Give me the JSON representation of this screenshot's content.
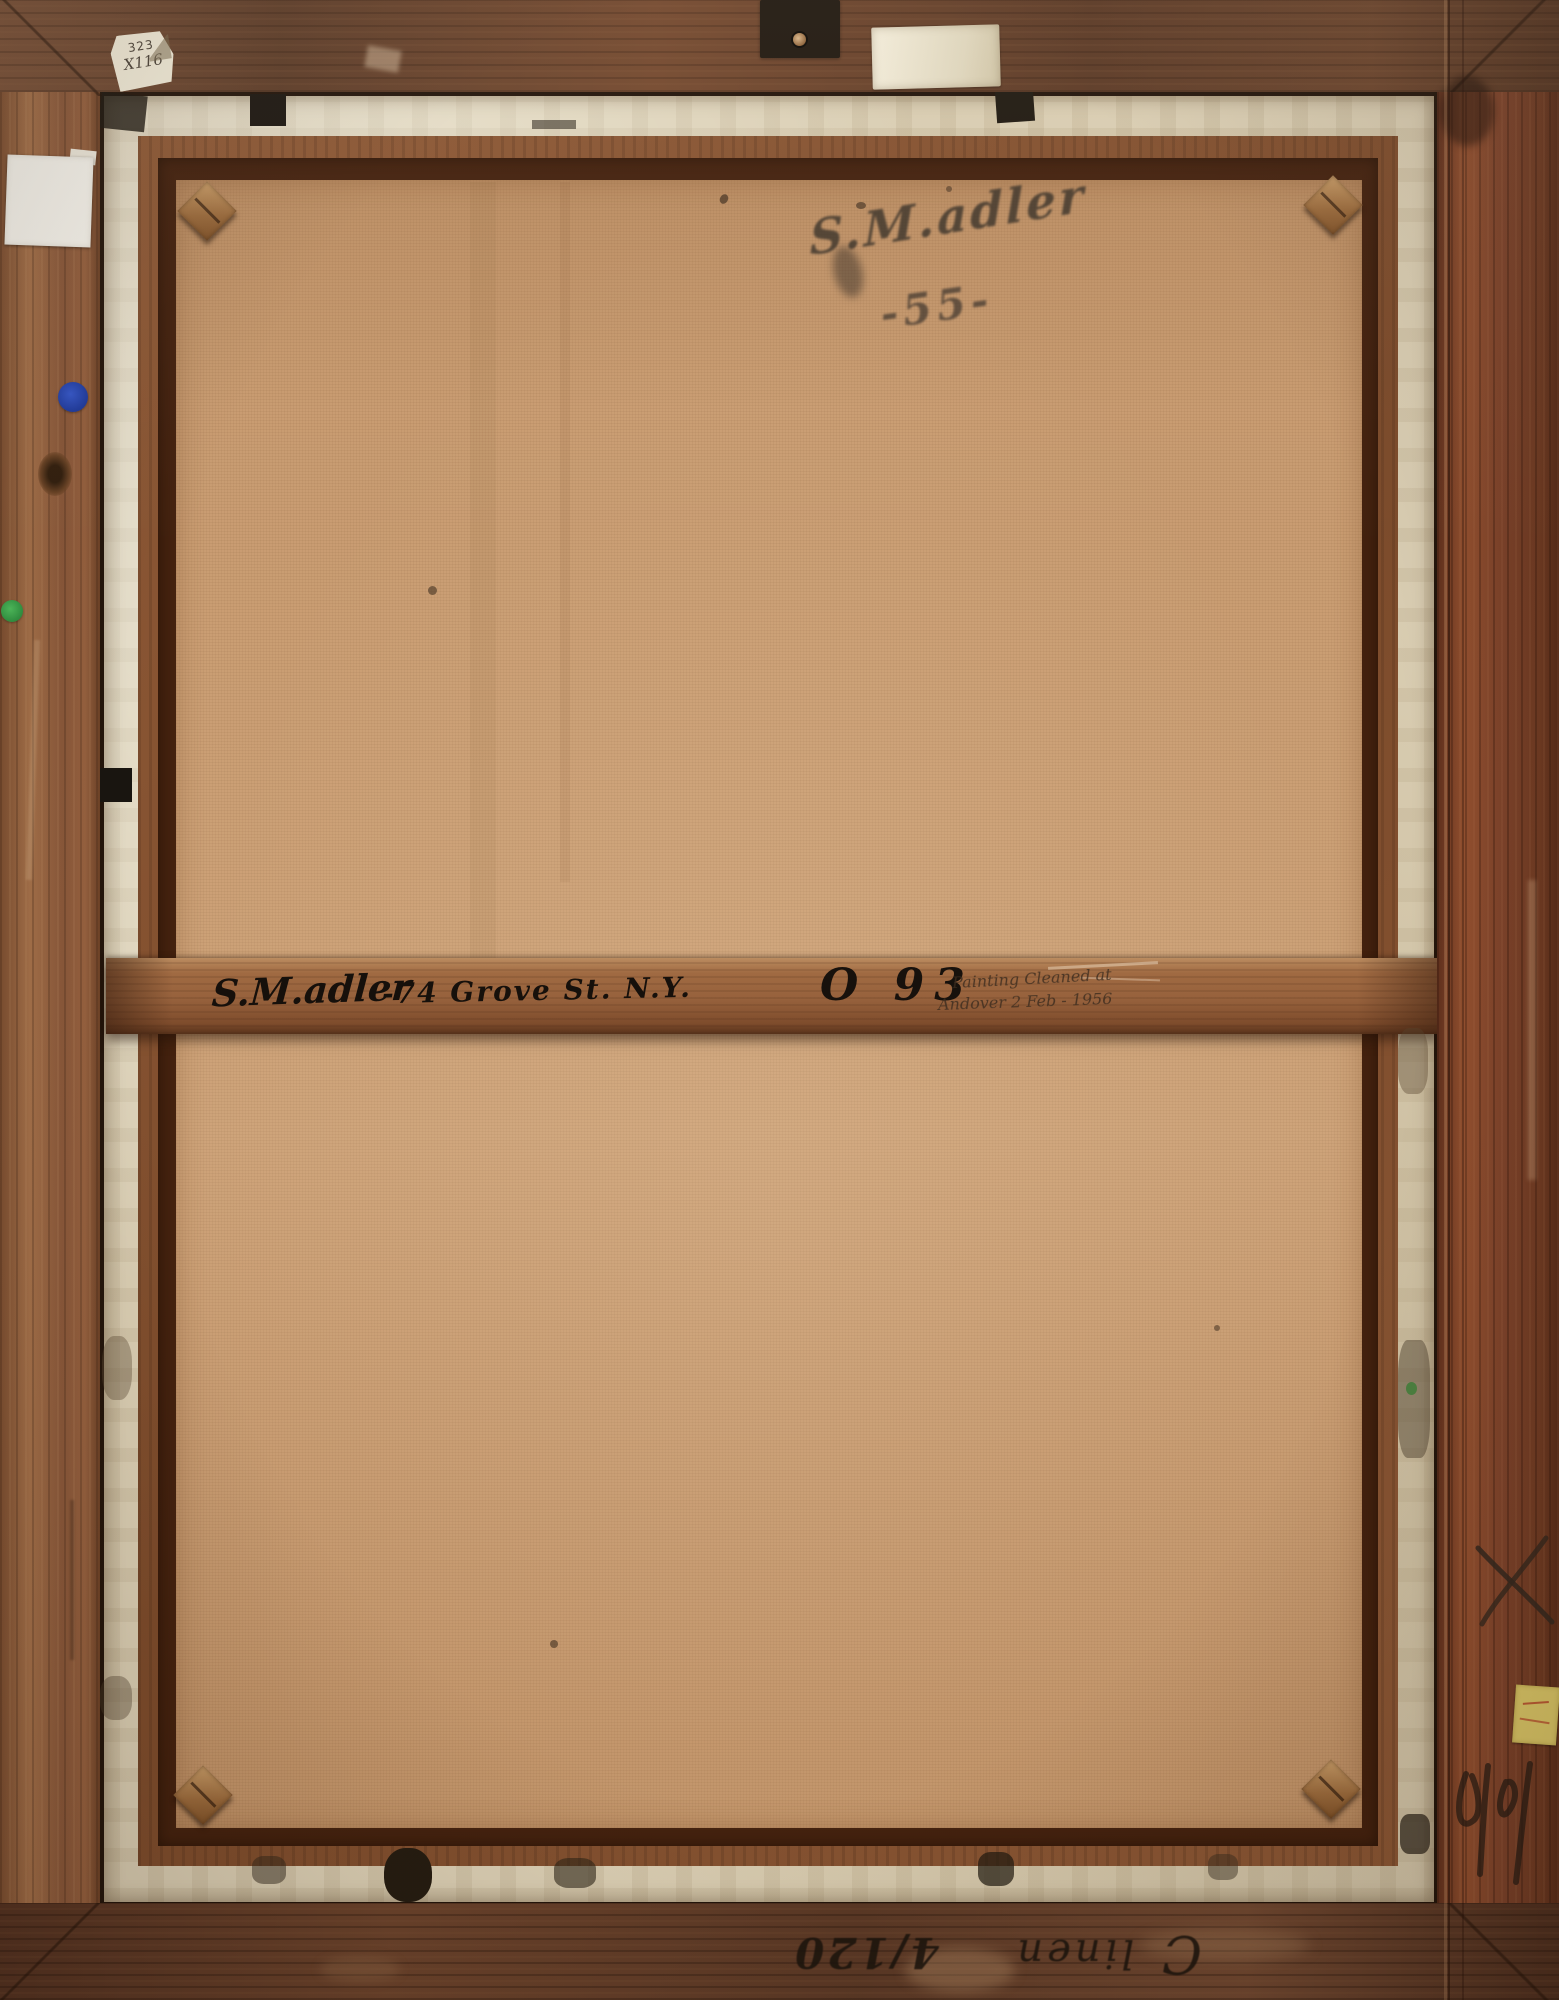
{
  "scene": {
    "description": "Verso of a framed painting: wooden frame, linen canvas on stretcher with crossbar, handwritten inscriptions and collection stickers",
    "artist_signature": {
      "name": "S.M.adler",
      "date": "-55-"
    },
    "crossbar": {
      "name": "S.M.adler",
      "address": "-74 Grove St. N.Y.",
      "number": "O 93",
      "pencil_line1": "Painting Cleaned at",
      "pencil_line2": "Andover 2 Feb - 1956"
    },
    "labels": {
      "top_left_line1": "323",
      "top_left_line2": "X116"
    },
    "bottom_frame": {
      "letter": "C",
      "word": "linen",
      "number": "4/120"
    },
    "colors": {
      "canvas": "#c89b70",
      "frame": "#96613f",
      "tacking_edge": "#d9cdb2",
      "ink": "#17110c",
      "blue_sticker": "#2a4cb8",
      "green_sticker": "#3fae4e",
      "yellow_label": "#d9c566"
    }
  }
}
